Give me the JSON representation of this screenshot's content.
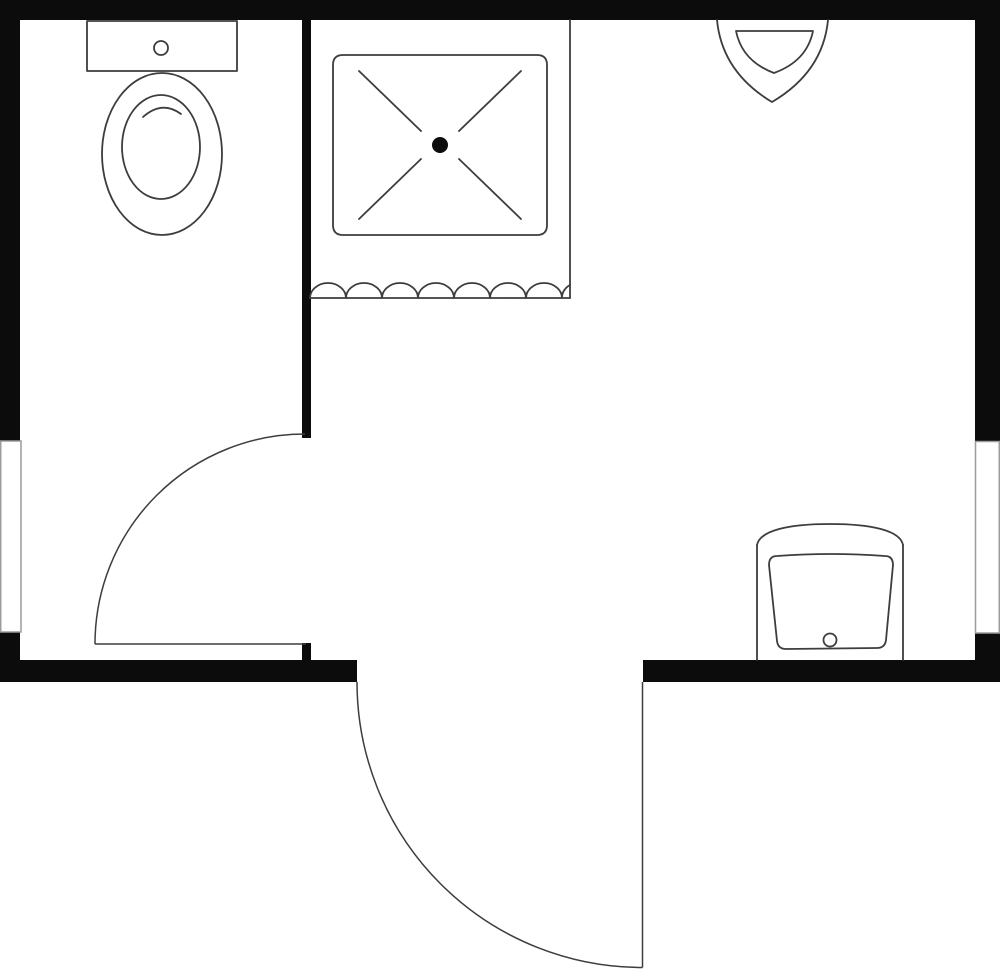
{
  "canvas": {
    "width": 1000,
    "height": 969,
    "view_box": "0 0 1000 969"
  },
  "colors": {
    "wall": "#0c0c0c",
    "fixture_line": "#3d3d3d",
    "window_frame": "#9c9c9c",
    "background": "#ffffff"
  },
  "floor_plan": {
    "walls": {
      "top": "M0,0 H1000 V20 H0 Z",
      "left_upper": "M0,20 H20 V441 H0 Z",
      "left_lower": "M0,632 H20 V682 H0 Z",
      "right_upper": "M975,20 H1000 V441 H975 Z",
      "right_lower": "M975,633 H1000 V682 H975 Z",
      "bottom_left": "M0,660 H357 V682 H0 Z",
      "bottom_right": "M643,660 H1000 V682 H643 Z",
      "partition": "M302,0 H311 V438 H302 Z",
      "partition_stub": "M302,643 H311 V660 H302 Z"
    },
    "windows": {
      "left": "M0.75,441 H21 V632 H0.75 Z",
      "right": "M975.5,441.5 H999.25 V633 H975.5 Z"
    },
    "doors": {
      "interior": {
        "leaf": "M95,644 H306",
        "swing_arc": "M95,644 A210,210 0 0 1 305,434"
      },
      "exterior": {
        "leaf": "M642.5,682 V967.5",
        "swing_arc": "M357,682 A285.5,285.5 0 0 0 642.5,967.5"
      }
    },
    "fixtures": {
      "toilet": {
        "tank": "M87,21 H237 V71 H87 Z",
        "flush_button": "M154,48 a7,7 0 1 0 14,0 a7,7 0 1 0 -14,0 Z",
        "bowl_outer": "M102,154 a60,81 0 1 0 120,0 a60,81 0 1 0 -120,0 Z",
        "bowl_inner": "M122,147 a39,52 0 1 0 78,0 a39,52 0 1 0 -78,0 Z",
        "rim_arc": "M143,117 Q162,100 181,114"
      },
      "shower": {
        "enclosure_edge": "M570,20 V298",
        "curtain_rail": "M310,298 H570",
        "curtain_scallops": "M310,298 a18,15 0 0 1 36,0 a18,15 0 0 1 36,0 a18,15 0 0 1 36,0 a18,15 0 0 1 36,0 a18,15 0 0 1 36,0 a18,15 0 0 1 36,0 a18,15 0 0 1 36,0 a18,15 0 0 1 8,-13",
        "pan": "M343,55 H537 Q547,55 547,65 V225 Q547,235 537,235 H343 Q333,235 333,225 V65 Q333,55 343,55 Z",
        "spray_tl": "M359,71 L421,131",
        "spray_tr": "M521,71 L459,131",
        "spray_bl": "M359,219 L421,159",
        "spray_br": "M521,219 L459,159",
        "drain": "M432,145 a8,8 0 1 0 16,0 a8,8 0 1 0 -16,0 Z"
      },
      "corner_basin": {
        "outer": "M717,20 Q722,72 772,102 Q823,72 828,20",
        "inner": "M736,31 H813 Q807,61 774,73 Q742,61 736,31 Z"
      },
      "vanity_sink": {
        "left_edge": "M757,545 V660",
        "right_edge": "M903,545 V660",
        "back_arch": "M757,545 C760,530 790,524 830,524 C870,524 900,530 903,545",
        "basin": "M769,565 Q769,556 777,556 Q831,552 885,556 Q893,556 893,565 L886,640 Q885,648 877,648 L786,649 Q778,649 777,641 Z",
        "drain": "M823.5,640 a6.5,6.5 0 1 0 13,0 a6.5,6.5 0 1 0 -13,0 Z"
      }
    }
  }
}
